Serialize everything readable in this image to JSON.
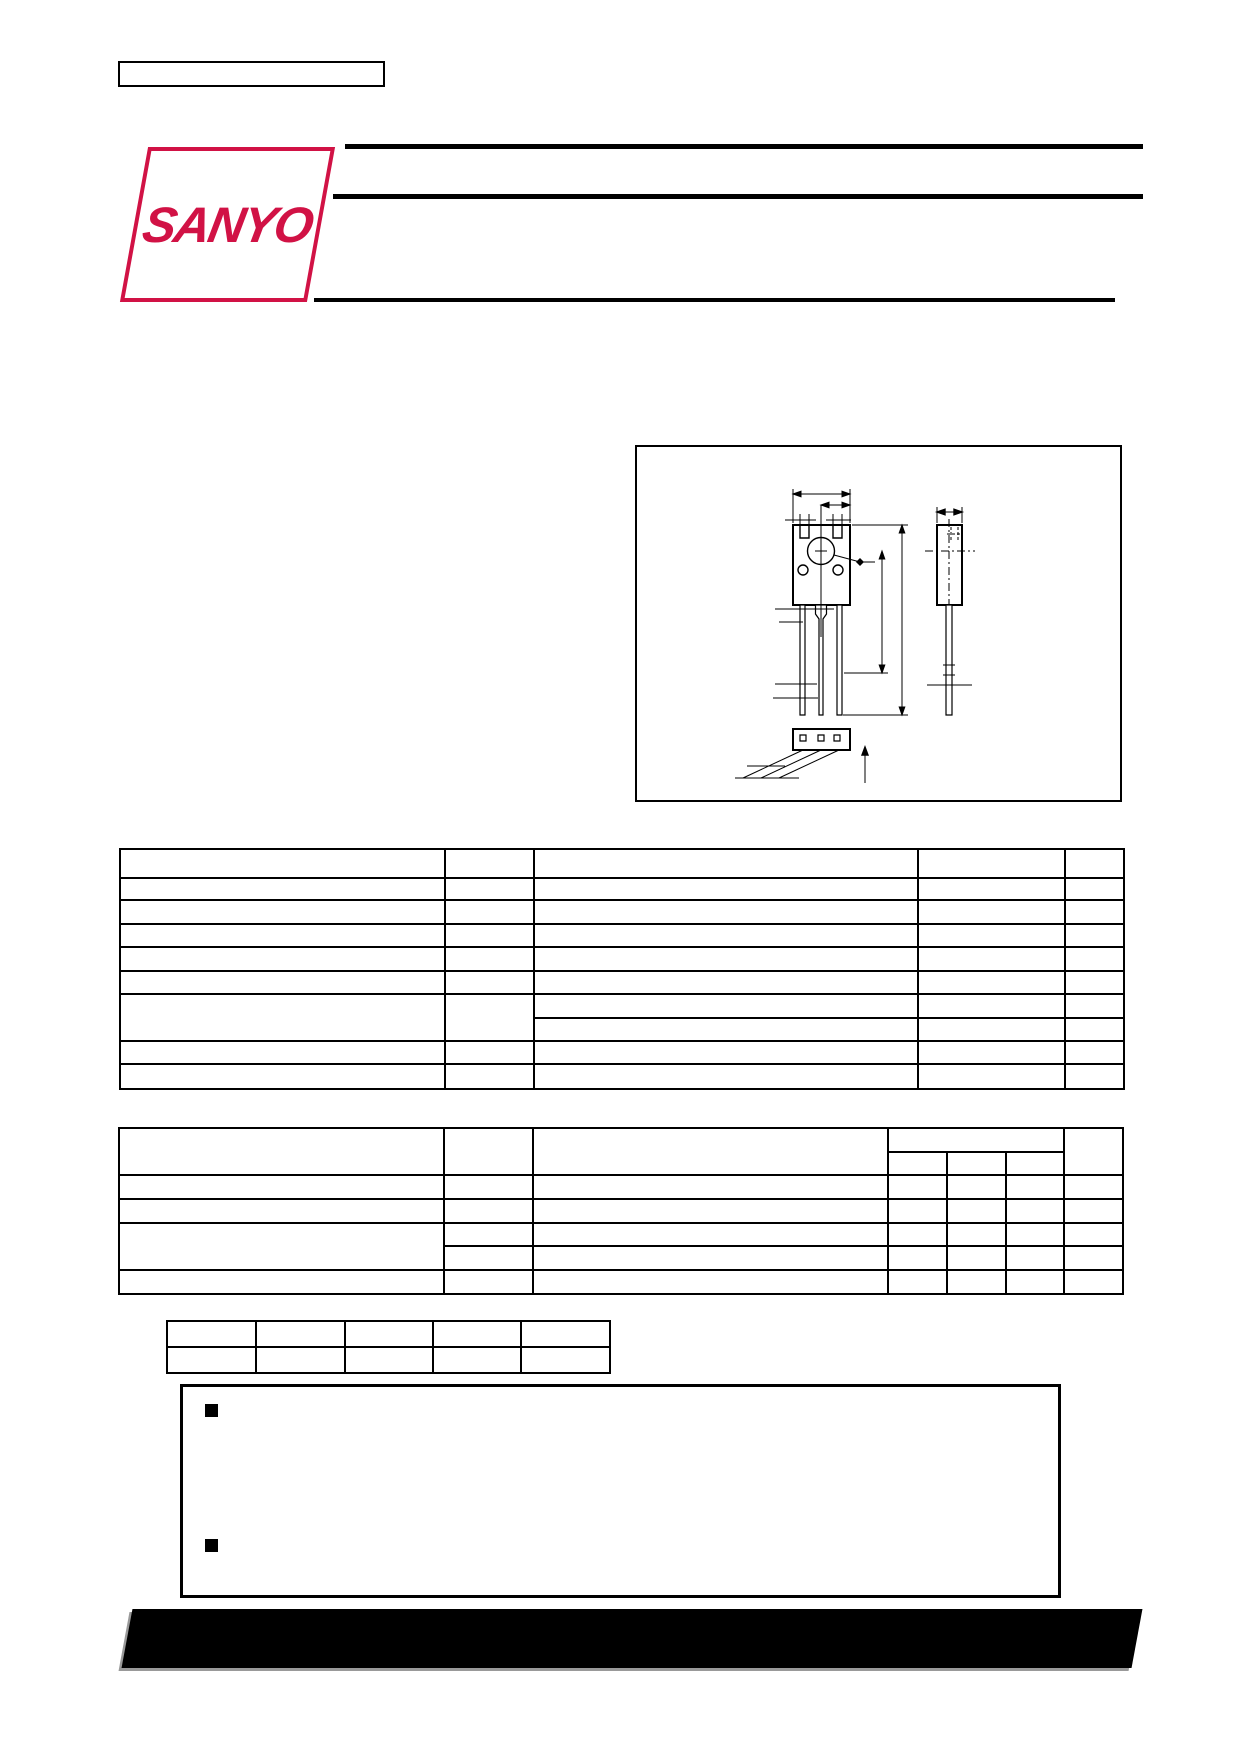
{
  "logo": {
    "text": "SANYO",
    "color": "#d11245"
  },
  "colors": {
    "ink": "#000000",
    "footer_bar": "#000000",
    "footer_shadow": "#999999",
    "background": "#ffffff"
  },
  "structure": {
    "ordering_number_box": "empty rectangle, top-left",
    "title_rules": "two thick rules right of logo and one rule below, all blank (text not rendered)",
    "package_diagram": "transistor package outline: front view with mounting hole and two small holes, three leads, side view, bottom view, dimension lines; no dimension text rendered",
    "maximum_ratings_table": {
      "columns": 5,
      "data_rows": 9,
      "merged_parameter_rows": 2,
      "all_cells_empty": true
    },
    "electrical_characteristics_table": {
      "columns": 7,
      "data_rows": 5,
      "header_subcolumns": 3,
      "merged_parameter_rows": 2,
      "all_cells_empty": true
    },
    "classification_table": {
      "columns": 5,
      "rows": 2,
      "all_cells_empty": true
    },
    "note_box": {
      "bullet_count": 2,
      "text": ""
    },
    "footer": "black slanted bar with gray shadow, no text rendered"
  }
}
